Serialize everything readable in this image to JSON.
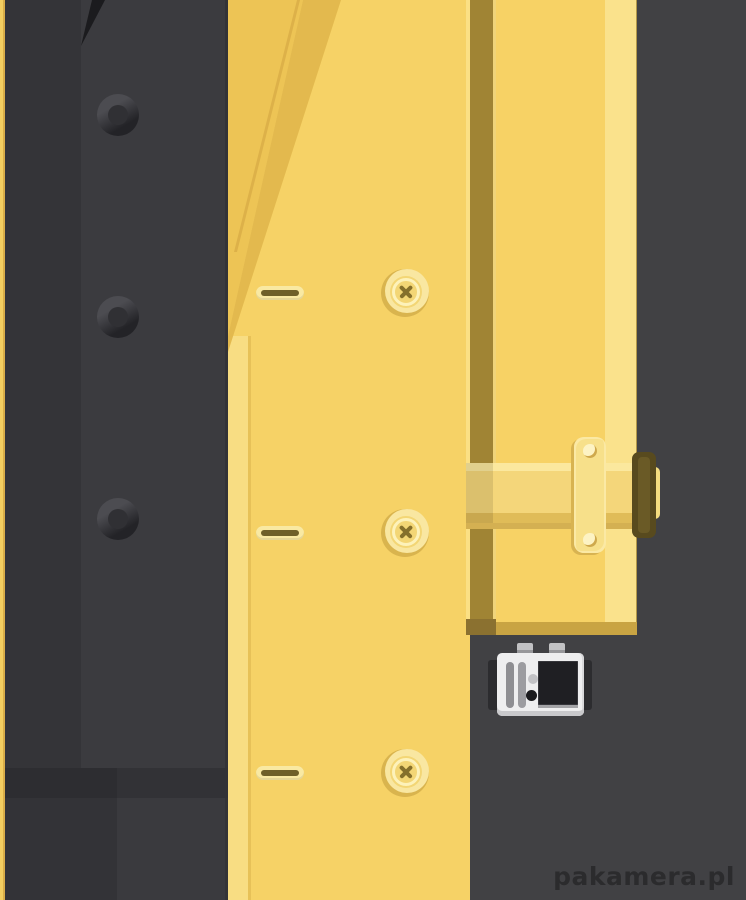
{
  "watermark": {
    "text": "pakamera.pl"
  },
  "scene": {
    "objects": [
      "dark-suit-jacket",
      "suit-buttons",
      "yellow-trench-coat",
      "coat-buttons-cross-stitch",
      "coat-buttonholes",
      "coat-lapel",
      "belt-with-loop-and-buckle",
      "voice-recorder-device"
    ]
  },
  "palette": {
    "bg": "#414144",
    "suit_left": "#343438",
    "suit_right": "#3b3b3f",
    "suit_notch": "#1b1b1e",
    "suit_hem_left": "#2d2d31",
    "suit_hem_right": "#323236",
    "suit_leg_left": "#333337",
    "suit_leg_right": "#3a3a3e",
    "ring_light": "#4c4c51",
    "ring_dark": "#232327",
    "ring_hole": "#303034",
    "coat_sliver": "#f3cd60",
    "sliver_edge": "#d9ad48",
    "coat_main": "#f6d266",
    "coat_left_hl": "#f8dd83",
    "coat_left_hl_edge": "#e7c158",
    "lapel_face": "#edc455",
    "lapel_band": "#e3b94e",
    "lapel_crease": "#ddb149",
    "seam": "#a08434",
    "seam_edge_l": "#fbe084",
    "seam_edge_r": "#f0d47a",
    "coat_right": "#f7d265",
    "coat_right_hl": "#fae28c",
    "coat_bottom_band": "#c9a443",
    "coat_bottom_band_dark": "#8b7130",
    "hole_outer": "#f9e9a2",
    "hole_inner": "#6f6028",
    "btn_base": "#d9b44e",
    "btn_face": "#f9e7a1",
    "btn_disc": "#f3d675",
    "btn_ring": "#fdf2ba",
    "btn_stitch": "#85702c",
    "belt_top": "#fbe89e",
    "belt_body": "#f4d67a",
    "belt_bottom": "#e0bc58",
    "belt_shadow": "#d4b052",
    "belt_tip": "#f4dc80",
    "loop_fill": "#f7e08a",
    "loop_edge": "#fbe9a4",
    "loop_shadow": "#d8b351",
    "rivet": "#fdf3c4",
    "rivet_shadow": "#cfa94c",
    "buckle": "#584a1e",
    "buckle_inner": "#6a5a26",
    "device_body": "#eeeeef",
    "device_flap": "#2c2c2f",
    "device_tab": "#c2c2c4",
    "device_tab_dark": "#97979a",
    "device_bar1": "#8e8e92",
    "device_bar2": "#9c9ca0",
    "device_circle": "#c2c2c5",
    "device_dot": "#1a1a1d",
    "device_screen": "#1f1f23",
    "device_screen_shadow": "#a3a3a6",
    "device_strip": "#c9c9cc",
    "watermark": "#2b2b2d"
  }
}
